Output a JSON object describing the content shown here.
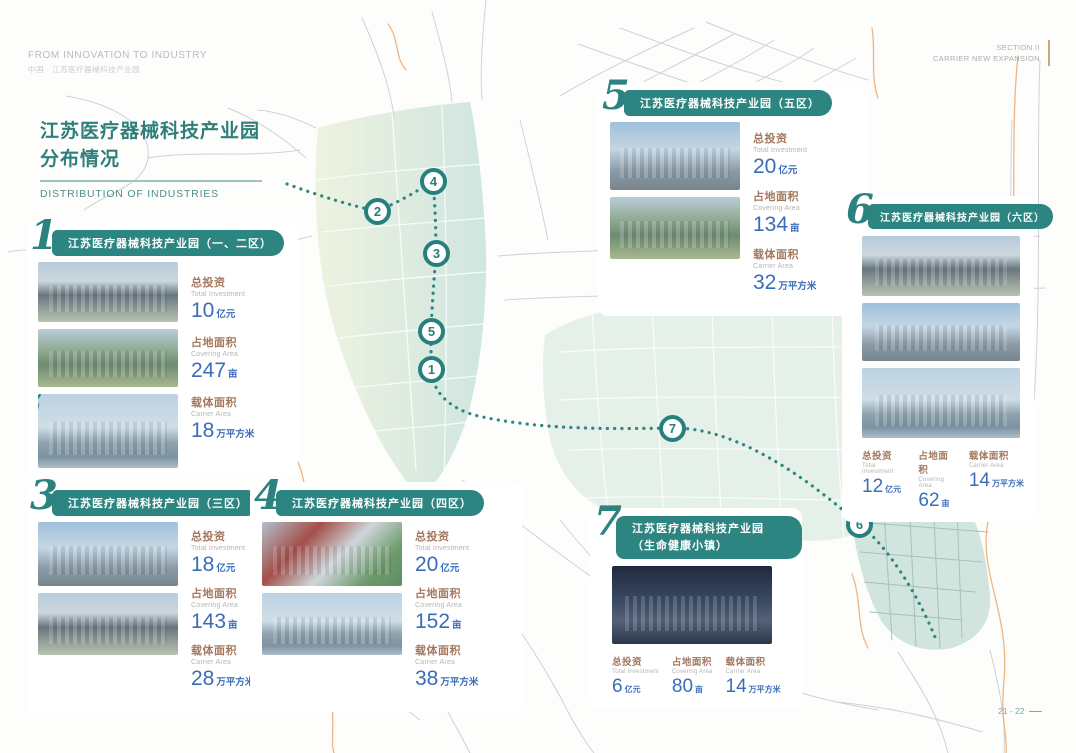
{
  "colors": {
    "teal_accent": "#2c8581",
    "number_blue": "#3a6db8",
    "label_brown": "#a3785e",
    "gold_rule": "#c9a87c",
    "map_green_band": "#d8e8dd",
    "orange_boundary": "#efb583"
  },
  "header": {
    "top_left_line1": "FROM INNOVATION TO INDUSTRY",
    "top_left_line2": "中国 · 江苏医疗器械科技产业园",
    "top_right_line1": "SECTION II",
    "top_right_line2": "CARRIER NEW EXPANSION"
  },
  "title": {
    "line1": "江苏医疗器械科技产业园",
    "line2": "分布情况",
    "subtitle": "DISTRIBUTION OF INDUSTRIES"
  },
  "labels": {
    "investment_cn": "总投资",
    "investment_en": "Total Investment",
    "area_cn": "占地面积",
    "area_en": "Covering Area",
    "carrier_cn": "载体面积",
    "carrier_en": "Carrier Area",
    "unit_investment": "亿元",
    "unit_area": "亩",
    "unit_carrier": "万平方米"
  },
  "parks": [
    {
      "num": "1",
      "num2": "2",
      "title": "江苏医疗器械科技产业园（一、二区）",
      "investment": "10",
      "area": "247",
      "carrier": "18"
    },
    {
      "num": "3",
      "title": "江苏医疗器械科技产业园（三区）",
      "investment": "18",
      "area": "143",
      "carrier": "28"
    },
    {
      "num": "4",
      "title": "江苏医疗器械科技产业园（四区）",
      "investment": "20",
      "area": "152",
      "carrier": "38"
    },
    {
      "num": "5",
      "title": "江苏医疗器械科技产业园（五区）",
      "investment": "20",
      "area": "134",
      "carrier": "32"
    },
    {
      "num": "6",
      "title": "江苏医疗器械科技产业园（六区）",
      "investment": "12",
      "area": "62",
      "carrier": "14"
    },
    {
      "num": "7",
      "title": "江苏医疗器械科技产业园",
      "title2": "（生命健康小镇）",
      "investment": "6",
      "area": "80",
      "carrier": "14"
    }
  ],
  "map_markers": [
    "1",
    "2",
    "3",
    "4",
    "5",
    "6",
    "7"
  ],
  "page_number": "21 - 22"
}
